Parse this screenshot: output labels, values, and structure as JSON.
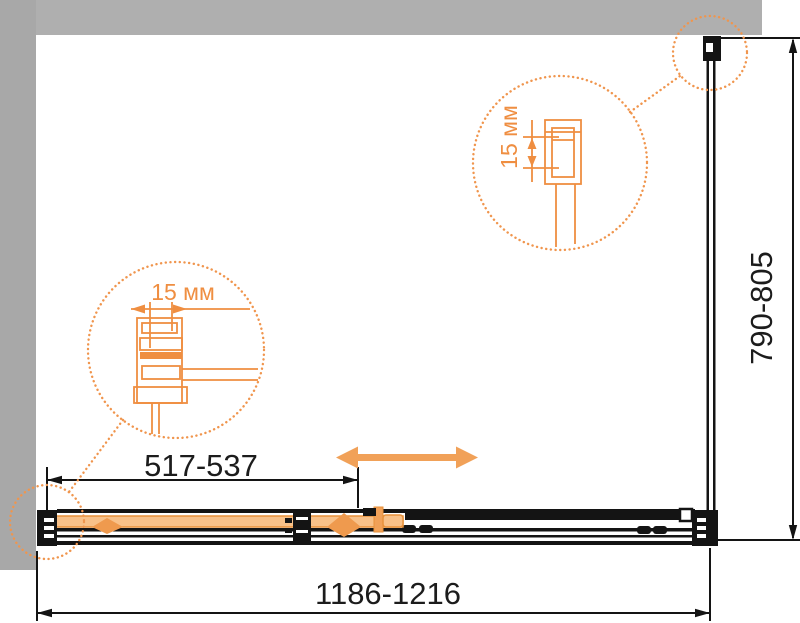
{
  "dimensions": {
    "overall_width": "1186-1216",
    "overall_depth": "790-805",
    "door_opening": "517-537"
  },
  "details": {
    "left_adjustment": "15 мм",
    "right_adjustment": "15 мм"
  },
  "colors": {
    "wall_gray_left": "#a8a8a8",
    "wall_gray_top": "#afafaf",
    "drawing_black": "#141414",
    "accent_orange": "#ef8e41",
    "accent_orange_light": "#f8c189",
    "arrow_orange": "#f1a158",
    "background": "#ffffff"
  }
}
